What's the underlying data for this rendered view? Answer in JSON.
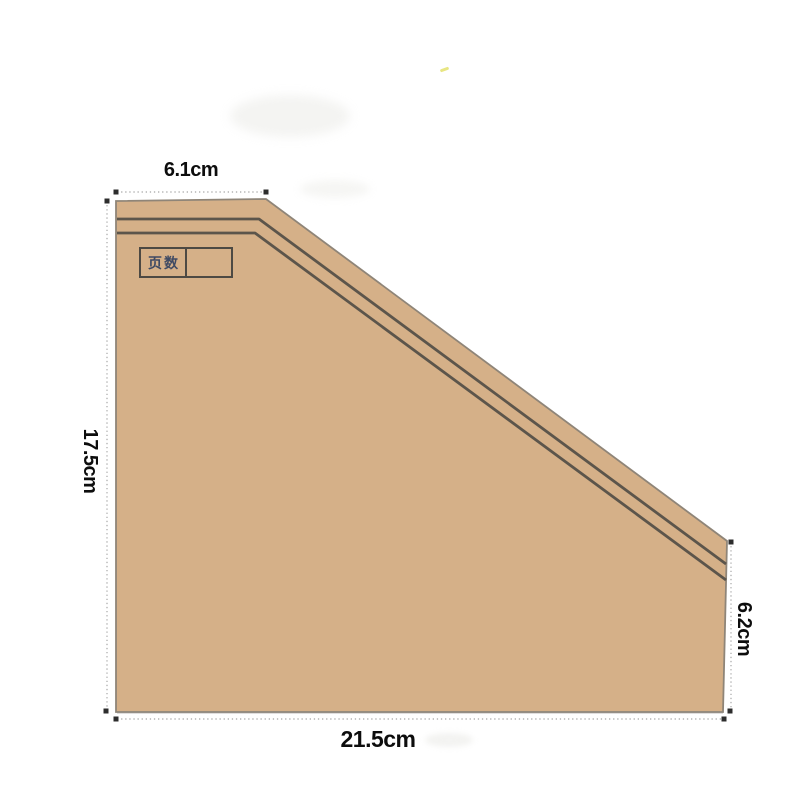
{
  "dimensions": {
    "top_width": "6.1cm",
    "left_height": "17.5cm",
    "right_height": "6.2cm",
    "bottom_width": "21.5cm"
  },
  "labels": {
    "page_count": "页数"
  },
  "colors": {
    "background": "#ffffff",
    "kraft_fill": "#d5b088",
    "outline": "#8f8578",
    "stitch_line": "#5c554b",
    "box_border": "#4d4943",
    "page_count_text": "#3f4a63",
    "dimension_line": "#b3b3b3",
    "marker": "#2d2d2d",
    "label_text": "#0d0d0d"
  }
}
